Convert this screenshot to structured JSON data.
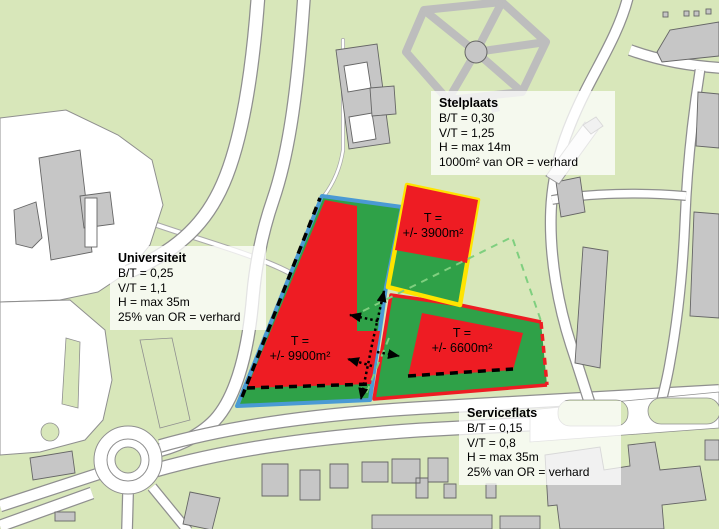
{
  "map": {
    "title": "Site development plan (zoning scheme)",
    "zones": {
      "universiteit": {
        "title": "Universiteit",
        "params": [
          "B/T = 0,25",
          "V/T = 1,1",
          "H = max 35m",
          "25% van OR = verhard"
        ],
        "area_line1": "T =",
        "area_line2": "+/- 9900m²",
        "outline_color": "#4a9ad4"
      },
      "stelplaats": {
        "title": "Stelplaats",
        "params": [
          "B/T = 0,30",
          "V/T = 1,25",
          "H = max 14m",
          "1000m² van OR = verhard"
        ],
        "area_line1": "T =",
        "area_line2": "+/- 3900m²",
        "outline_color": "#ffe400"
      },
      "serviceflats": {
        "title": "Serviceflats",
        "params": [
          "B/T = 0,15",
          "V/T = 0,8",
          "H = max 35m",
          "25% van OR = verhard"
        ],
        "area_line1": "T =",
        "area_line2": "+/- 6600m²",
        "outline_color": "#ee1c23"
      }
    },
    "colors": {
      "zone_fill_red": "#ee1c23",
      "zone_fill_green": "#2fa148",
      "planned_outline_dashed_green": "#7fcf7f",
      "map_background": "#d8e7ba",
      "road": "#ffffff",
      "building": "#c6c6c6",
      "arrow": "#000000"
    }
  }
}
